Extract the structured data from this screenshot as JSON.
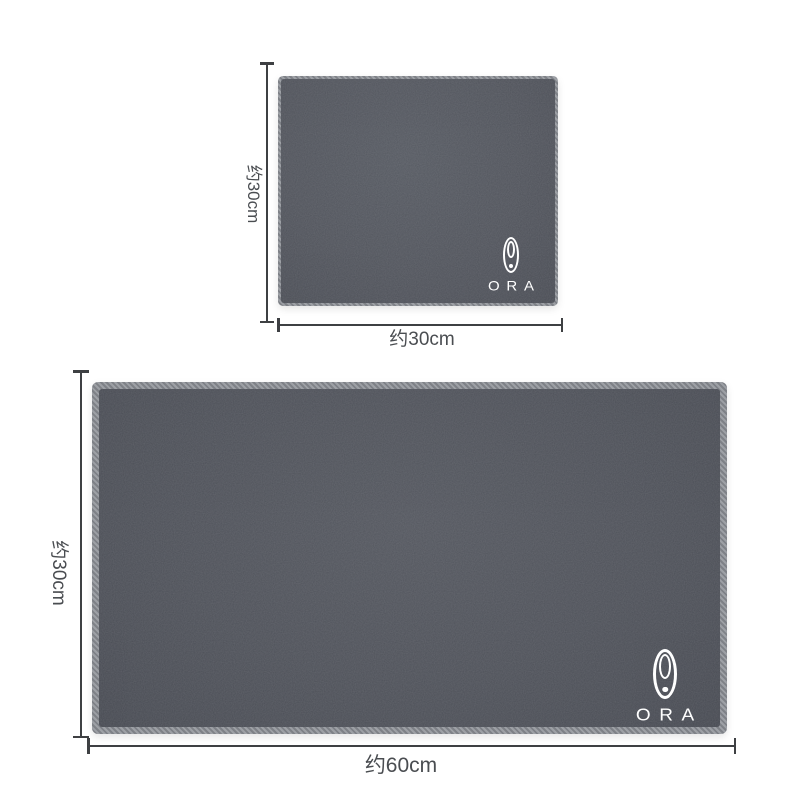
{
  "product_figure": {
    "brand": "ORA",
    "small_towel": {
      "logo_text": "ORA",
      "height_label": "约30cm",
      "width_label": "约30cm"
    },
    "large_towel": {
      "logo_text": "ORA",
      "height_label": "约30cm",
      "width_label": "约60cm"
    }
  },
  "theme": {
    "background": "#ffffff",
    "fabric_small": "#51545c",
    "fabric_large": "#4e5159",
    "stitch_light": "#9da0a5",
    "stitch_dark": "#7e8187",
    "dim_line": "#3e4043",
    "dim_text": "#4a4d51",
    "logo_white": "#ffffff"
  }
}
